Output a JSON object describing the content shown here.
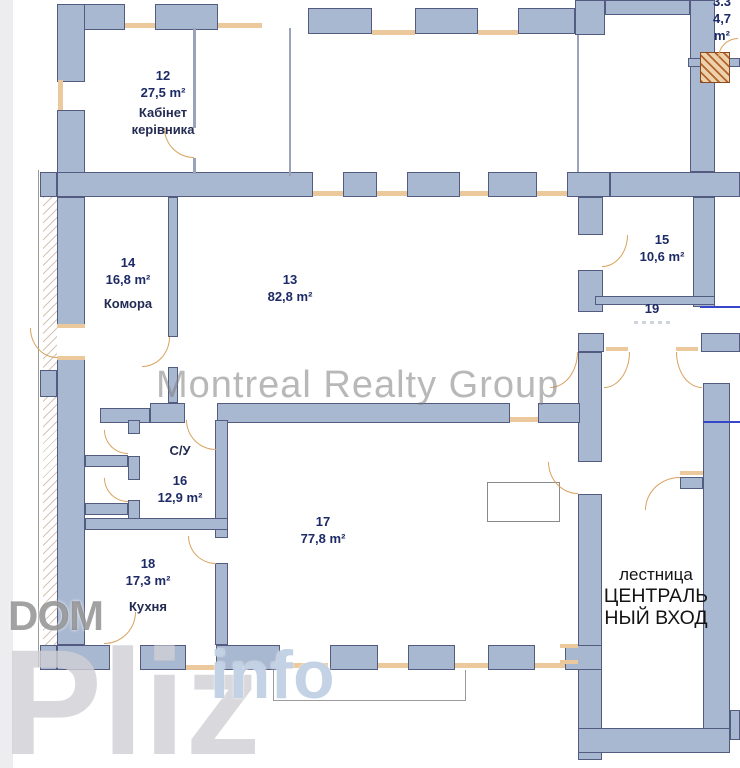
{
  "watermarks": {
    "center": "Montreal Realty Group",
    "dom": "DOM",
    "pliz": "Pliz",
    "info": "info"
  },
  "rooms": {
    "r12": {
      "number": "12",
      "area": "27,5 m²",
      "name": "Кабінет\nкерівника"
    },
    "r13": {
      "number": "13",
      "area": "82,8 m²"
    },
    "r14": {
      "number": "14",
      "area": "16,8 m²",
      "name": "Комора"
    },
    "r15": {
      "number": "15",
      "area": "10,6 m²"
    },
    "r16": {
      "number": "16",
      "area": "12,9 m²",
      "name": "С/У"
    },
    "r17": {
      "number": "17",
      "area": "77,8 m²"
    },
    "r18": {
      "number": "18",
      "area": "17,3 m²",
      "name": "Кухня"
    },
    "r19": {
      "number": "19"
    },
    "r33": {
      "number": "3.3",
      "area": "4,7 m²"
    }
  },
  "stairwell": {
    "label": "лестница",
    "entrance": "ЦЕНТРАЛЬ\nНЫЙ ВХОД"
  },
  "colors": {
    "wall": "#a9b8d1",
    "wall_outline": "#545b80",
    "window": "#ecc89d",
    "door_arc": "#d9a25f",
    "room_label": "#1d2a66",
    "stair_text": "#141414",
    "annotation_line": "#3646c8"
  }
}
